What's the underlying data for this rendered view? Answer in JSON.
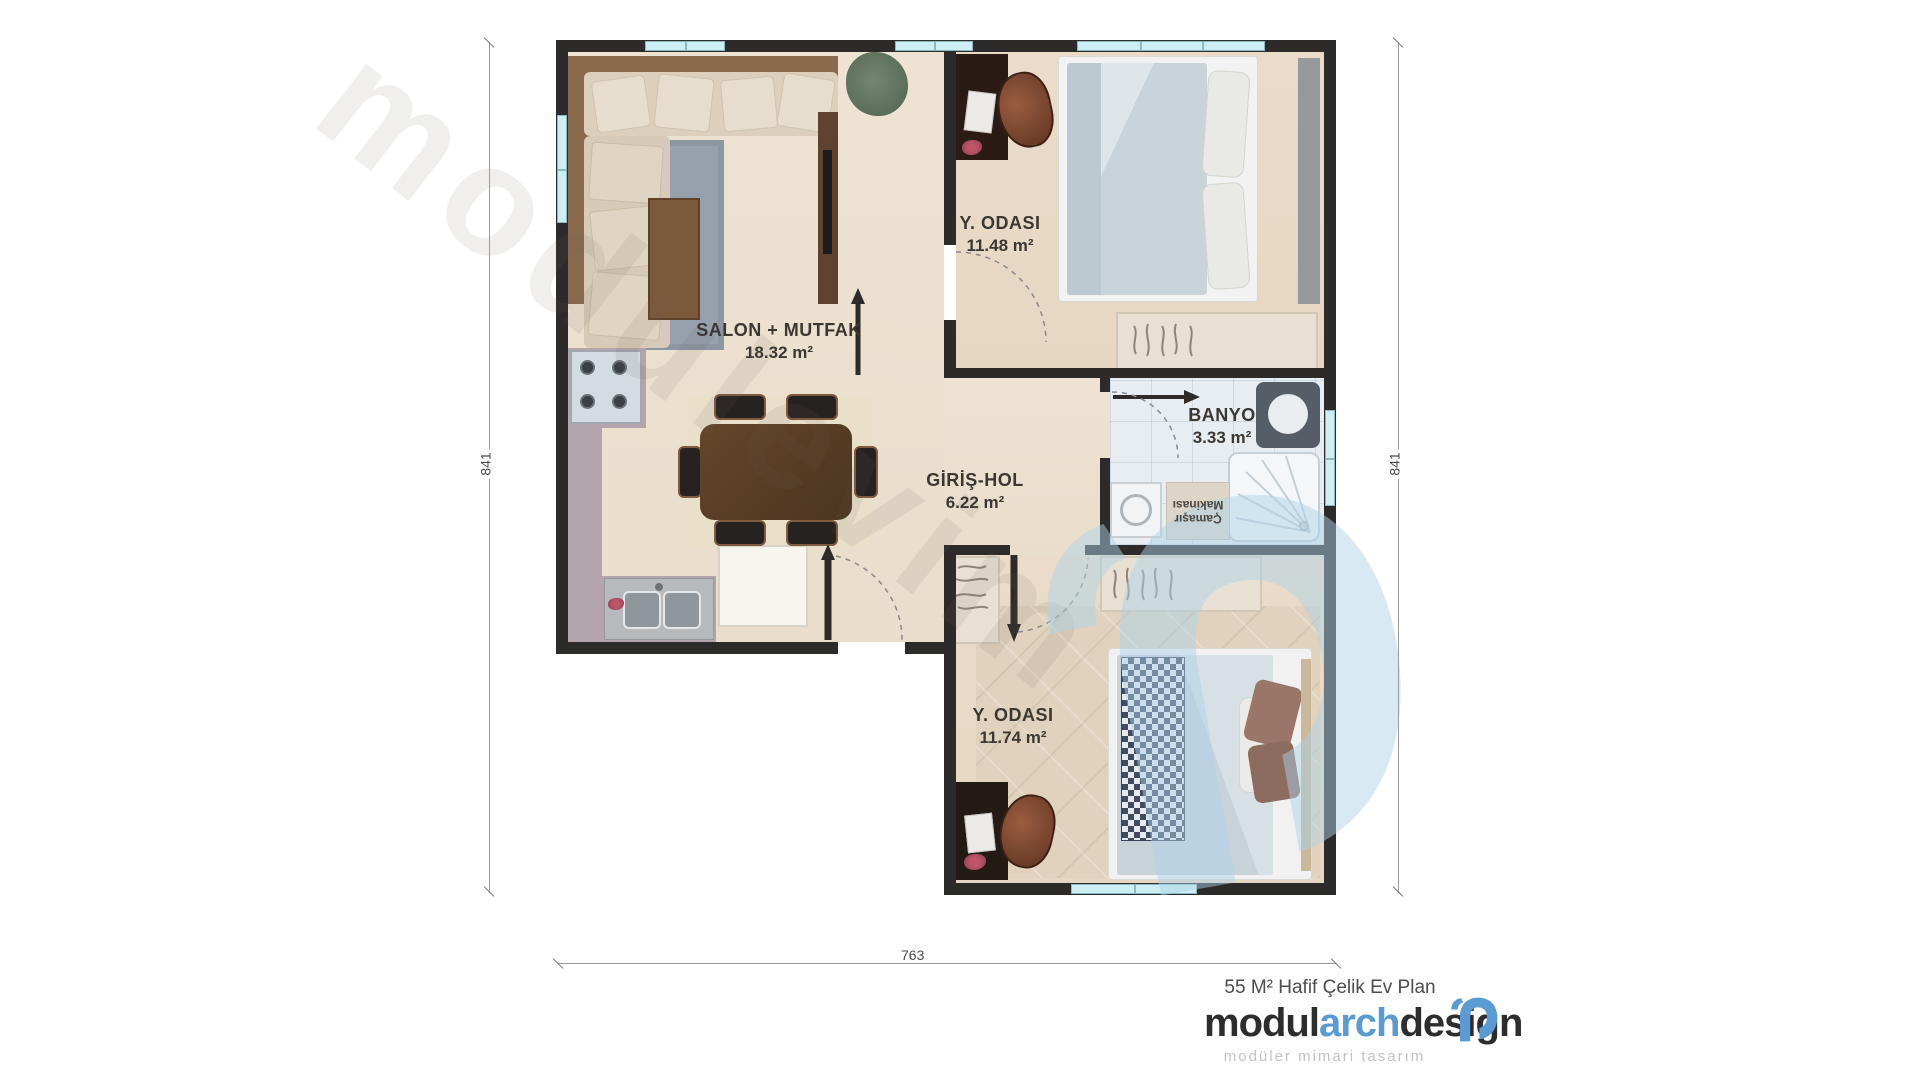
{
  "watermark": {
    "text": "modulevim"
  },
  "rooms": {
    "salon": {
      "name": "SALON + MUTFAK",
      "area": "18.32 m²"
    },
    "bedroom_top": {
      "name": "Y. ODASI",
      "area": "11.48 m²"
    },
    "bathroom": {
      "name": "BANYO",
      "area": "3.33 m²"
    },
    "hall": {
      "name": "GİRİŞ-HOL",
      "area": "6.22 m²"
    },
    "bedroom_bottom": {
      "name": "Y. ODASI",
      "area": "11.74 m²"
    },
    "laundry": {
      "line1": "Çamaşır",
      "line2": "Makinası"
    }
  },
  "dimensions": {
    "left": "841",
    "right": "841",
    "bottom": "763"
  },
  "branding": {
    "plan_title": "55 M² Hafif Çelik Ev Plan",
    "logo_part1": "modul",
    "logo_part2": "arch",
    "logo_part3": "design",
    "tagline": "modüler mimari tasarım",
    "accent_blue": "#5b9bd3",
    "text_dark": "#2d2d2d"
  },
  "colors": {
    "wall": "#2d2b29",
    "window": "#cdeef3",
    "floor": "#ece2d2",
    "salon_rug": "#96a1ad",
    "counter": "#b2a5ab",
    "watermark_blue": "#aed3ea"
  }
}
